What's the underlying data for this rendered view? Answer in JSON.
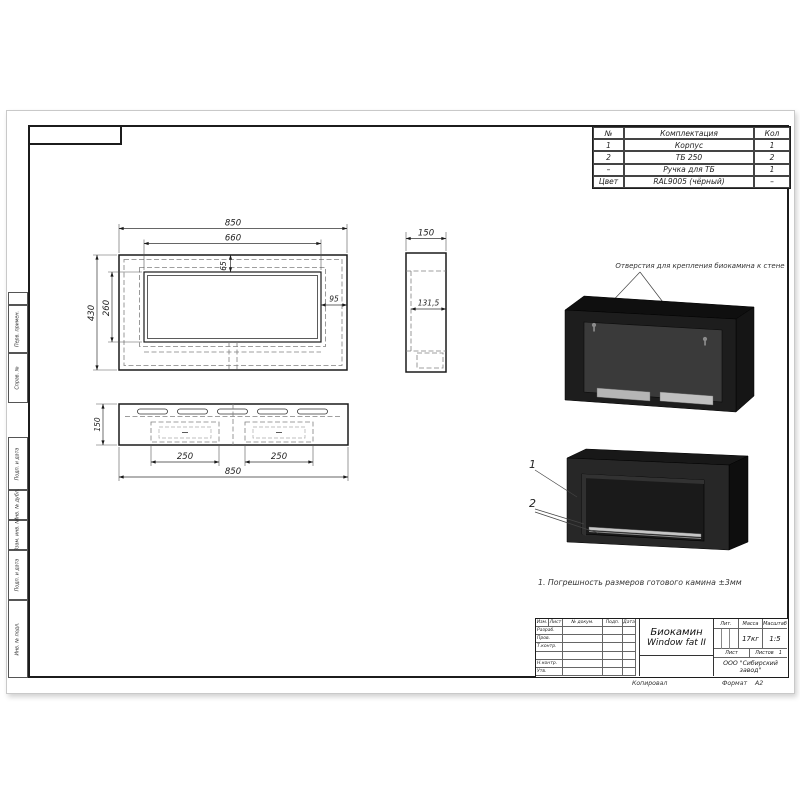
{
  "parts_table": {
    "headers": [
      "№",
      "Комплектация",
      "Кол"
    ],
    "rows": [
      [
        "1",
        "Корпус",
        "1"
      ],
      [
        "2",
        "ТБ 250",
        "2"
      ],
      [
        "–",
        "Ручка для ТБ",
        "1"
      ],
      [
        "Цвет",
        "RAL9005 (чёрный)",
        "–"
      ]
    ]
  },
  "dimensions": {
    "front_width": "850",
    "front_opening_width": "660",
    "front_opening_top_offset": "65",
    "front_height": "430",
    "front_opening_height": "260",
    "front_right_offset": "95",
    "side_depth": "150",
    "side_inner_depth": "131,5",
    "bottom_depth": "150",
    "bottom_burner_left": "250",
    "bottom_burner_right": "250",
    "bottom_width": "850"
  },
  "annotations": {
    "mounting_note": "Отверстия для крепления биокамина к стене",
    "tolerance_note": "1. Погрешность размеров готового камина ±3мм",
    "callout_1": "1",
    "callout_2": "2"
  },
  "title_block": {
    "title_line1": "Биокамин",
    "title_line2": "Window fat II",
    "header_row": [
      "Изм.",
      "Лист",
      "№ докум.",
      "Подп.",
      "Дата"
    ],
    "row_labels": [
      "Разраб.",
      "Пров.",
      "Т.контр.",
      "",
      "Н.контр.",
      "Утв."
    ],
    "lit_label": "Лит.",
    "mass_label": "Масса",
    "mass_value": "17кг",
    "scale_label": "Масштаб",
    "scale_value": "1:5",
    "sheet_label": "Лист",
    "sheets_label": "Листов",
    "sheets_value": "1",
    "company_line1": "ООО \"Сибирский",
    "company_line2": "завод\"",
    "copied_label": "Копировал",
    "format_label": "Формат",
    "format_value": "А2"
  },
  "margin_columns": {
    "perv_primen": "Перв. примен.",
    "sprav_no": "Справ. №",
    "podp_data_1": "Подп. и дата",
    "inv_dubl": "Инв. № дубл.",
    "vzam_inv": "Взам. инв. №",
    "podp_data_2": "Подп. и дата",
    "inv_podl": "Инв. № подл."
  },
  "colors": {
    "line": "#1a1a1a",
    "body_dark": "#1e1e1e",
    "panel_gray": "#3a3a3a",
    "burner_silver": "#bfbfbf",
    "color_spec": "RAL9005"
  }
}
